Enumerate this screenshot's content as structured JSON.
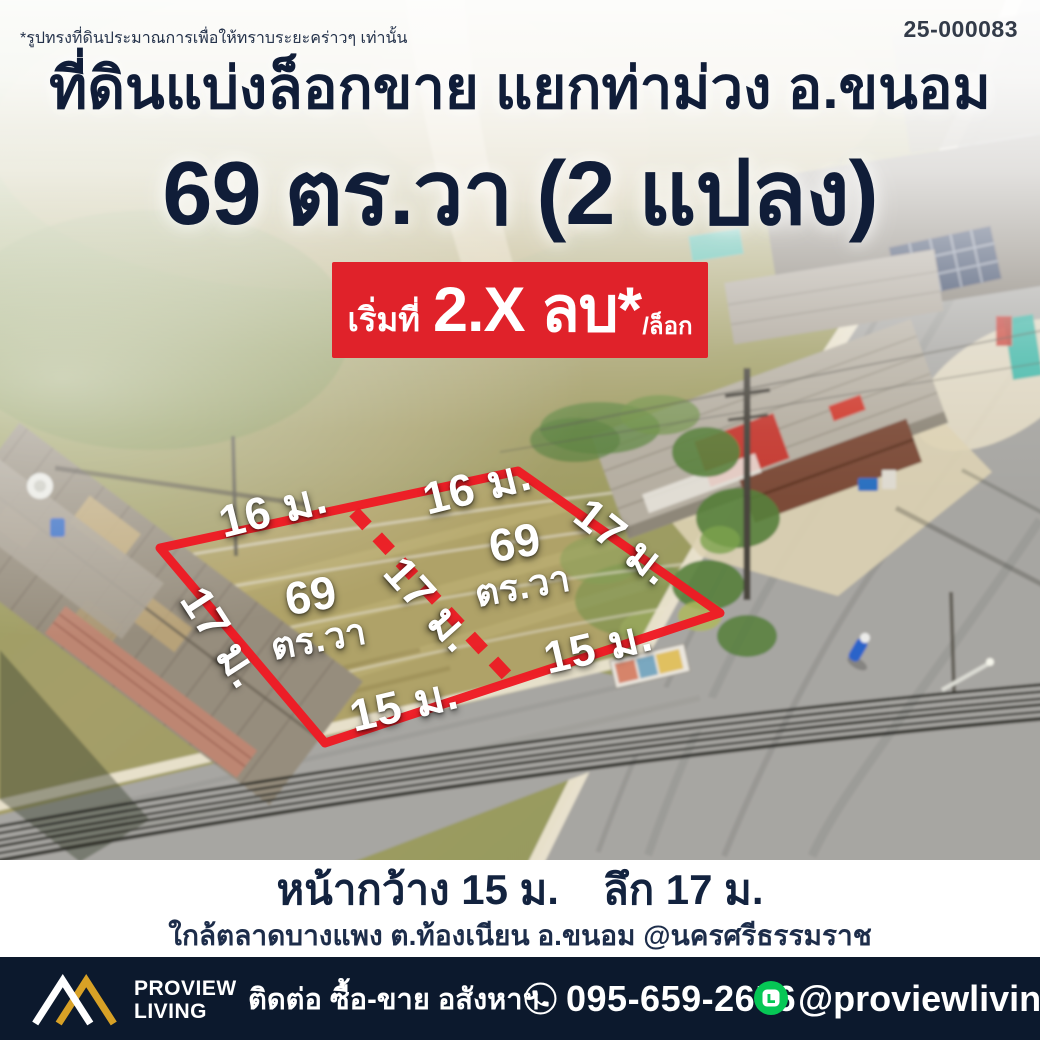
{
  "colors": {
    "accent_red": "#e0222a",
    "outline_red": "#ee1b24",
    "navy_text": "#101d38",
    "footer_bg": "#0c192d",
    "info_bg": "#ffffff",
    "line_green": "#06c755",
    "brand_gold": "#d8a126"
  },
  "top_bar": {
    "disclaimer": "*รูปทรงที่ดินประมาณการเพื่อให้ทราบระยะคร่าวๆ เท่านั้น",
    "ref_no": "25-000083"
  },
  "header": {
    "title": "ที่ดินแบ่งล็อกขาย แยกท่าม่วง อ.ขนอม",
    "subtitle": "69 ตร.วา (2 แปลง)",
    "badge": {
      "prefix": "เริ่มที่",
      "price": "2.X ลบ*",
      "per": "/ล็อก"
    }
  },
  "site_plan": {
    "dim_labels": [
      {
        "side": "top-left",
        "text": "16 ม."
      },
      {
        "side": "top-right",
        "text": "16 ม."
      },
      {
        "side": "right",
        "text": "17 ม."
      },
      {
        "side": "middle-divider",
        "text": "17 ม."
      },
      {
        "side": "left",
        "text": "17 ม."
      },
      {
        "side": "bottom-right",
        "text": "15 ม."
      },
      {
        "side": "bottom-left",
        "text": "15 ม."
      }
    ],
    "plots": [
      {
        "area_value": "69",
        "area_unit": "ตร.วา"
      },
      {
        "area_value": "69",
        "area_unit": "ตร.วา"
      }
    ]
  },
  "info_bar": {
    "frontage": "หน้ากว้าง 15 ม.",
    "depth": "ลึก 17 ม.",
    "location": "ใกล้ตลาดบางแพง ต.ท้องเนียน อ.ขนอม @นครศรีธรรมราช"
  },
  "footer": {
    "brand_line1": "PROVIEW",
    "brand_line2": "LIVING",
    "contact_label": "ติดต่อ ซื้อ-ขาย อสังหาฯ",
    "phone": "095-659-2656",
    "line_id": "@proviewliving"
  },
  "icons": {
    "phone": "phone-circle-icon",
    "line": "line-app-icon",
    "logo": "proview-mountains-logo"
  }
}
